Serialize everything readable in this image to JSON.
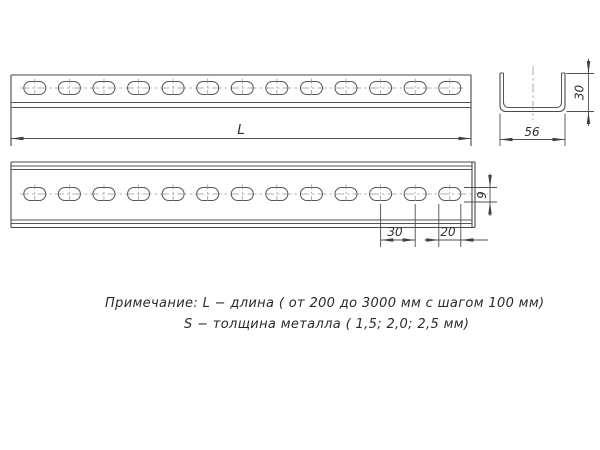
{
  "drawing": {
    "note": {
      "line1": "Примечание: L − длина ( от 200 до 3000 мм с шагом 100 мм)",
      "line2": "S − толщина металла ( 1,5; 2,0; 2,5 мм)"
    },
    "dimensions": {
      "length_label": "L",
      "profile_height_mm": "30",
      "profile_width_mm": "56",
      "slot_pitch_mm": "30",
      "slot_length_mm": "20",
      "slot_height_mm": "9"
    },
    "profile": {
      "slot_count_per_view": 13,
      "views": [
        "top view",
        "front view",
        "cross-section"
      ]
    },
    "colors": {
      "line": "#4a4a4a",
      "centerline": "#979797",
      "text": "#2f2f2f",
      "background": "#ffffff"
    }
  }
}
